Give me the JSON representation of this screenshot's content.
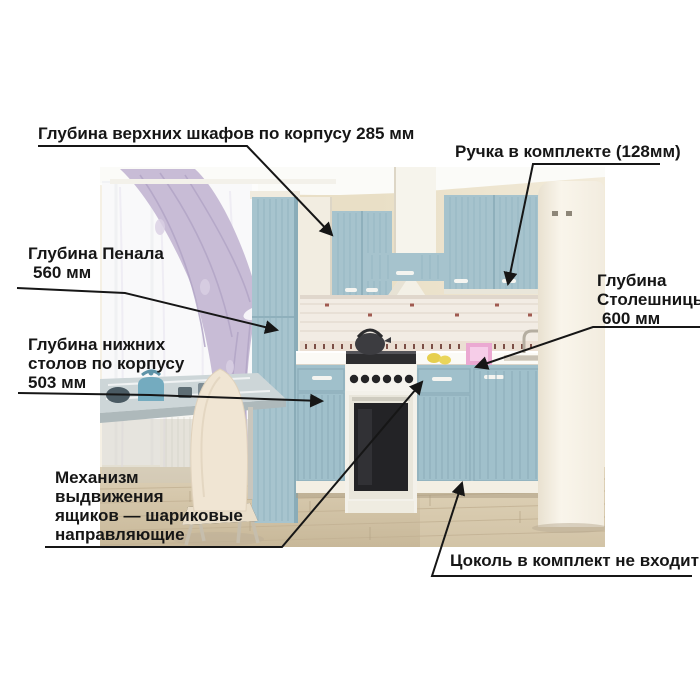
{
  "colors": {
    "background": "#ffffff",
    "label_text": "#161616",
    "leader_line": "#161616",
    "cabinet_blue": "#a6c3cd",
    "curtain_lilac": "#c8bcd6",
    "wall_beige": "#e9dfc6",
    "floor_wood": "#d3c3a7",
    "fridge_cream": "#f6f1e7",
    "countertop_white": "#fbfaf6",
    "oven_black": "#232326",
    "table_kettle_teal": "#74abbf",
    "chair_cream": "#f0e5d3"
  },
  "annotations": {
    "upper_cabinets_depth": {
      "text": "Глубина верхних шкафов по корпусу 285 мм",
      "value_mm": 285
    },
    "handle_included": {
      "text": "Ручка в комплекте (128мм)",
      "value_mm": 128
    },
    "tall_cabinet_depth": {
      "lines": [
        "Глубина Пенала",
        "560 мм"
      ],
      "value_mm": 560
    },
    "base_cabinets_depth": {
      "lines": [
        "Глубина нижних",
        "столов по корпусу",
        "503 мм"
      ],
      "value_mm": 503
    },
    "countertop_depth": {
      "lines": [
        "Глубина",
        "Столешницы",
        "600 мм"
      ],
      "value_mm": 600
    },
    "drawer_mechanism": {
      "lines": [
        "Механизм",
        "выдвижения",
        "ящиков — шариковые",
        "направляющие"
      ]
    },
    "plinth_note": {
      "text": "Цоколь в комплект не входит"
    }
  },
  "scene": {
    "description": "Кухня с голубыми фасадами: пенал, верхние шкафы, вытяжка, плита, нижние столы, мойка, холодильник; слева окно с сиреневыми шторами, стеклянный стол и стул"
  }
}
